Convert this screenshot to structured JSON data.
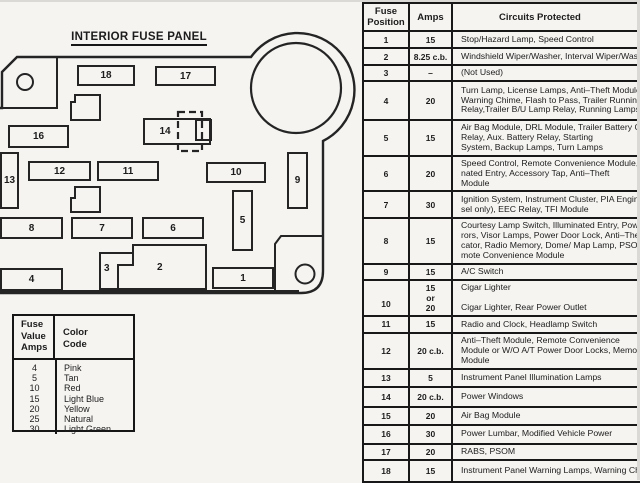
{
  "diagram": {
    "title": "INTERIOR FUSE PANEL",
    "fuses": [
      "1",
      "2",
      "3",
      "4",
      "5",
      "6",
      "7",
      "8",
      "9",
      "10",
      "11",
      "12",
      "13",
      "14",
      "15",
      "16",
      "17",
      "18"
    ]
  },
  "legend": {
    "header_amps": "Fuse\nValue\nAmps",
    "header_color": "Color\nCode",
    "rows": [
      {
        "amps": "4",
        "color": "Pink"
      },
      {
        "amps": "5",
        "color": "Tan"
      },
      {
        "amps": "10",
        "color": "Red"
      },
      {
        "amps": "15",
        "color": "Light Blue"
      },
      {
        "amps": "20",
        "color": "Yellow"
      },
      {
        "amps": "25",
        "color": "Natural"
      },
      {
        "amps": "30",
        "color": "Light Green"
      }
    ]
  },
  "table": {
    "headers": {
      "position": "Fuse\nPosition",
      "amps": "Amps",
      "circuits": "Circuits Protected"
    },
    "rows": [
      {
        "pos": "1",
        "amps": "15",
        "circuits": "Stop/Hazard Lamp, Speed Control"
      },
      {
        "pos": "2",
        "amps": "8.25 c.b.",
        "circuits": "Windshield Wiper/Washer, Interval Wiper/Washer"
      },
      {
        "pos": "3",
        "amps": "–",
        "circuits": "(Not Used)"
      },
      {
        "pos": "4",
        "amps": "20",
        "circuits": "Turn Lamp, License Lamps, Anti–Theft Module,\nWarning Chime, Flash to Pass, Trailer Running Lamp\nRelay,Trailer B/U Lamp Relay, Running Lamps"
      },
      {
        "pos": "5",
        "amps": "15",
        "circuits": "Air Bag Module, DRL Module, Trailer Battery Charger\nRelay, Aux. Battery Relay, Starting\nSystem, Backup Lamps, Turn Lamps"
      },
      {
        "pos": "6",
        "amps": "20",
        "circuits": "Speed Control, Remote Convenience Module, Illumi-\nnated Entry, Accessory Tap, Anti–Theft\nModule"
      },
      {
        "pos": "7",
        "amps": "30",
        "circuits": "Ignition System, Instrument Cluster, PIA Engine (die-\nsel only), EEC Relay, TFI Module"
      },
      {
        "pos": "8",
        "amps": "15",
        "circuits": "Courtesy Lamp Switch, Illuminated Entry, Power Mir-\nrors, Visor Lamps, Power Door Lock, Anti–Theft Indi-\ncator, Radio Memory, Dome/ Map Lamp, PSOM, Re-\nmote  Convenience Module"
      },
      {
        "pos": "9",
        "amps": "15",
        "circuits": "A/C Switch"
      },
      {
        "pos": "10",
        "amps": "15\nor\n20",
        "circuits": "Cigar Lighter\n\nCigar Lighter, Rear Power Outlet"
      },
      {
        "pos": "11",
        "amps": "15",
        "circuits": "Radio and Clock, Headlamp Switch"
      },
      {
        "pos": "12",
        "amps": "20 c.b.",
        "circuits": "Anti–Theft Module, Remote Convenience\nModule or W/O A/T Power Door Locks, Memory Lock\nModule"
      },
      {
        "pos": "13",
        "amps": "5",
        "circuits": "Instrument Panel Illumination Lamps"
      },
      {
        "pos": "14",
        "amps": "20 c.b.",
        "circuits": "Power Windows"
      },
      {
        "pos": "15",
        "amps": "20",
        "circuits": "Air Bag Module"
      },
      {
        "pos": "16",
        "amps": "30",
        "circuits": "Power Lumbar, Modified Vehicle Power"
      },
      {
        "pos": "17",
        "amps": "20",
        "circuits": "RABS, PSOM"
      },
      {
        "pos": "18",
        "amps": "15",
        "circuits": "Instrument Panel Warning Lamps, Warning Chime"
      }
    ]
  }
}
